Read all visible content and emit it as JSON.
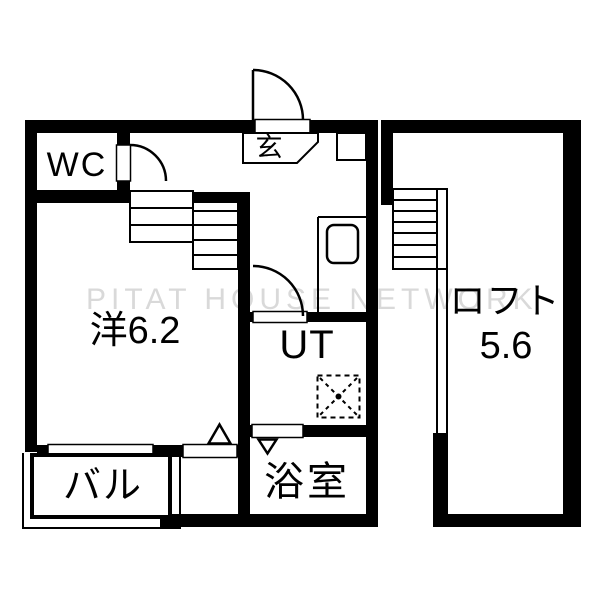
{
  "floorplan": {
    "watermark": "PITAT HOUSE NETWORK",
    "rooms": {
      "wc": "WC",
      "entrance": "玄",
      "western_room": "洋6.2",
      "utility": "UT",
      "bathroom": "浴室",
      "balcony": "バル",
      "loft_label": "ロフト",
      "loft_size": "5.6"
    },
    "colors": {
      "wall": "#000000",
      "background": "#ffffff",
      "watermark": "#d9d9d9"
    }
  }
}
